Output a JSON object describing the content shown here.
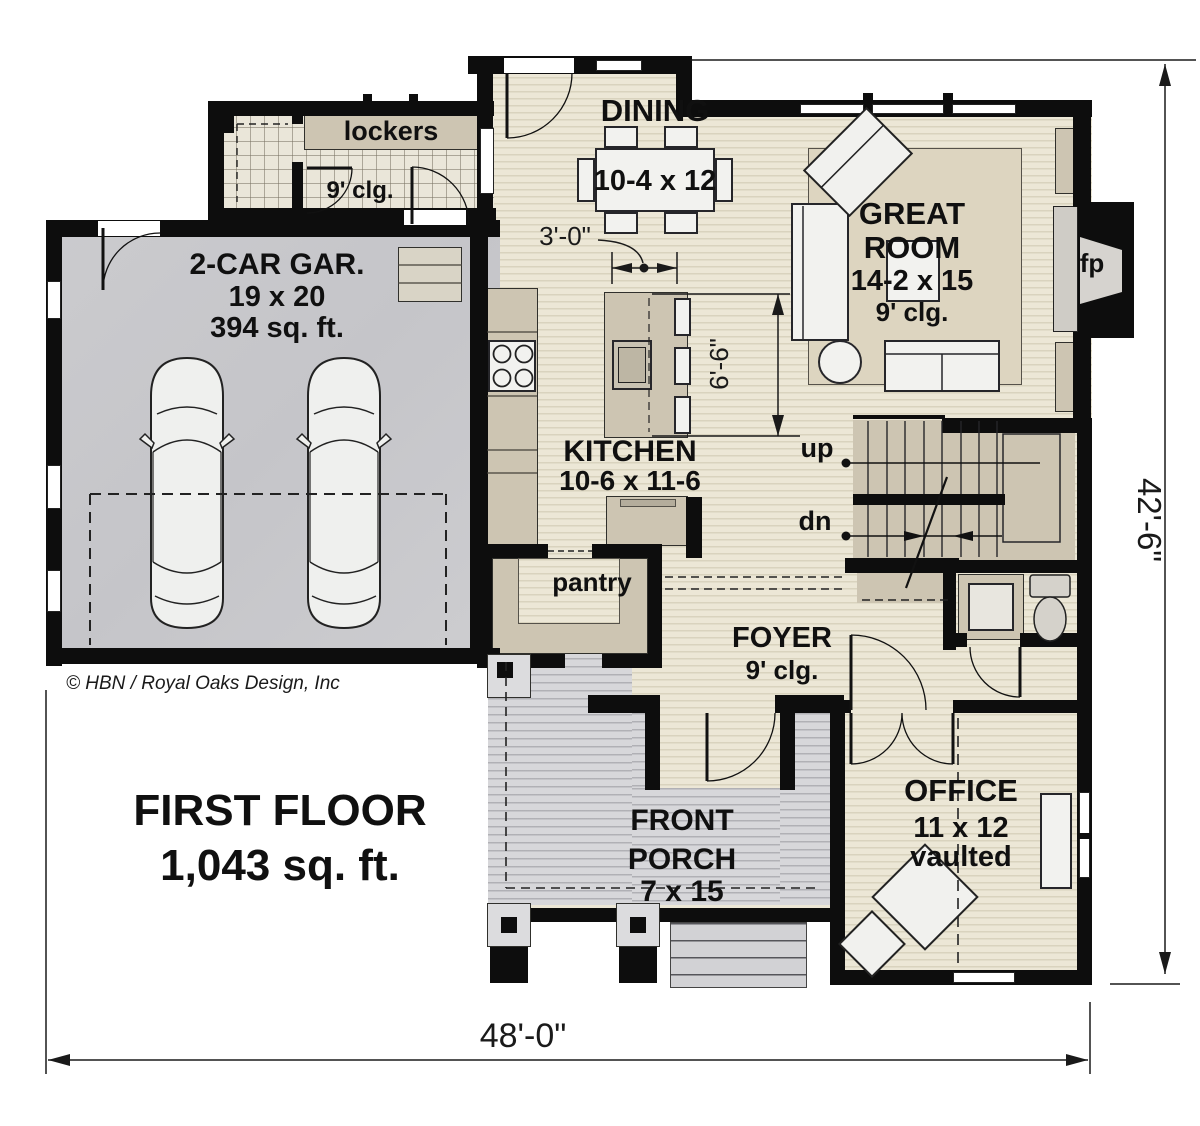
{
  "plan": {
    "garage": {
      "name": "2-CAR GAR.",
      "size": "19 x 20",
      "area": "394 sq. ft."
    },
    "mudroom": {
      "lockers": "lockers",
      "ceiling": "9' clg."
    },
    "dining": {
      "name": "DINING",
      "size": "10-4 x 12"
    },
    "great_room": {
      "name1": "GREAT",
      "name2": "ROOM",
      "size": "14-2 x 15",
      "ceiling": "9' clg."
    },
    "fireplace": {
      "label": "fp"
    },
    "kitchen": {
      "name": "KITCHEN",
      "size": "10-6 x 11-6"
    },
    "pantry": {
      "name": "pantry"
    },
    "stairs": {
      "up": "up",
      "dn": "dn"
    },
    "foyer": {
      "name": "FOYER",
      "ceiling": "9' clg."
    },
    "office": {
      "name": "OFFICE",
      "size": "11 x 12",
      "note": "vaulted"
    },
    "porch": {
      "name1": "FRONT",
      "name2": "PORCH",
      "size": "7 x 15"
    }
  },
  "dimensions": {
    "overall_width": "48'-0\"",
    "overall_height": "42'-6\"",
    "dining_clearance": "3'-0\"",
    "kitchen_clearance": "6'-6\""
  },
  "footer": {
    "floor_name": "FIRST FLOOR",
    "floor_area": "1,043 sq. ft.",
    "copyright": "© HBN / Royal Oaks Design, Inc"
  }
}
